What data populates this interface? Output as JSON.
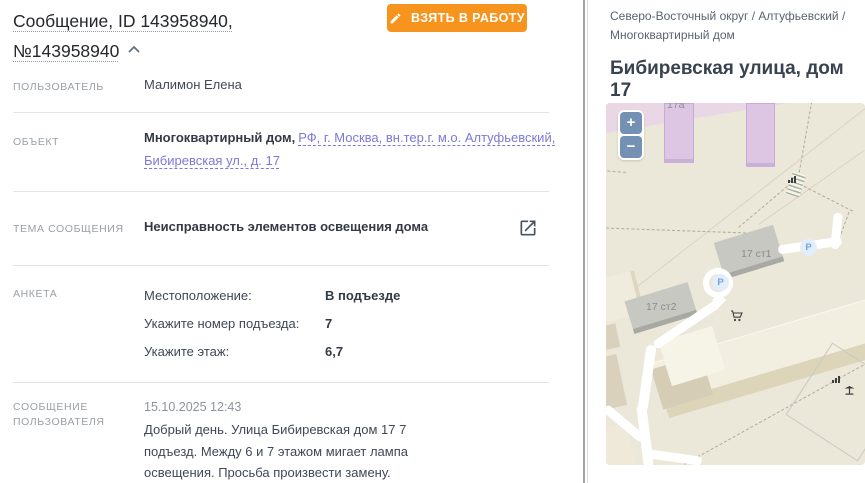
{
  "header": {
    "title": "Сообщение, ID 143958940, №143958940",
    "take_button": "ВЗЯТЬ В РАБОТУ"
  },
  "fields": {
    "user_label": "ПОЛЬЗОВАТЕЛЬ",
    "user_value": "Малимон Елена",
    "object_label": "ОБЪЕКТ",
    "object_type": "Многоквартирный дом,",
    "object_address": "РФ, г. Москва, вн.тер.г. м.о. Алтуфьевский, Бибиревская ул., д. 17",
    "topic_label": "ТЕМА СООБЩЕНИЯ",
    "topic_value": "Неисправность элементов освещения дома",
    "survey_label": "АНКЕТА",
    "survey": [
      {
        "q": "Местоположение:",
        "a": "В подъезде"
      },
      {
        "q": "Укажите номер подъезда:",
        "a": "7"
      },
      {
        "q": "Укажите этаж:",
        "a": "6,7"
      }
    ],
    "message_label": "СООБЩЕНИЕ ПОЛЬЗОВАТЕЛЯ",
    "message_date": "15.10.2025 12:43",
    "message_text": "Добрый день. Улица Бибиревская дом 17 7 подъезд. Между 6 и 7 этажом мигает лампа освещения. Просьба произвести замену."
  },
  "map_panel": {
    "breadcrumb": "Северо-Восточный округ / Алтуфьевский / Многоквартирный дом",
    "title": "Бибиревская улица, дом 17",
    "zoom_in": "+",
    "zoom_out": "−",
    "building_17a": "17а",
    "building_17s1": "17 ст1",
    "building_17s2": "17 ст2",
    "parking": "P"
  },
  "colors": {
    "accent_orange": "#F7941E",
    "link_purple": "#7B78D9",
    "map_background": "#EBE7D9",
    "zoom_button_blue": "#7490B2"
  }
}
